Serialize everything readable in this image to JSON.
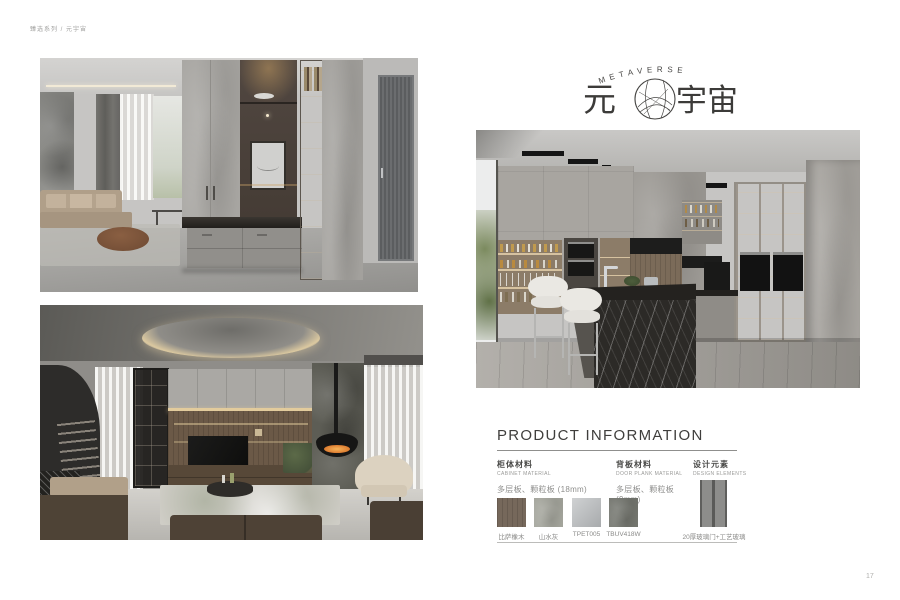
{
  "meta": {
    "breadcrumb": "臻选系列 / 元宇宙",
    "page_number": "17"
  },
  "logo": {
    "arc_text": "METAVERSE",
    "zh_first": "元",
    "zh_rest": "宇宙"
  },
  "product_info": {
    "title": "PRODUCT INFORMATION",
    "cabinet_material": {
      "cn": "柜体材料",
      "en": "CABINET MATERIAL",
      "value": "多层板、颗粒板 (18mm)"
    },
    "door_material": {
      "cn": "背板材料",
      "en": "DOOR PLANK MATERIAL",
      "value": "多层板、颗粒板 (9mm)"
    },
    "design_elements": {
      "cn": "设计元素",
      "en": "DESIGN ELEMENTS"
    },
    "swatches": [
      {
        "label": "比萨橡木",
        "color": "#76685b"
      },
      {
        "label": "山水灰",
        "color": "#a3a49b"
      },
      {
        "label": "TPET005",
        "color": "#b6b9bb"
      },
      {
        "label": "TBUV418W",
        "color": "#73756e"
      }
    ],
    "design_swatch": {
      "label": "20厚玻璃门+工艺玻璃",
      "color": "#8d8d8b"
    }
  },
  "colors": {
    "accent_warm_light": "#e2cb9c",
    "text_dark": "#3f3e3c",
    "text_muted": "#8e8e8c"
  }
}
